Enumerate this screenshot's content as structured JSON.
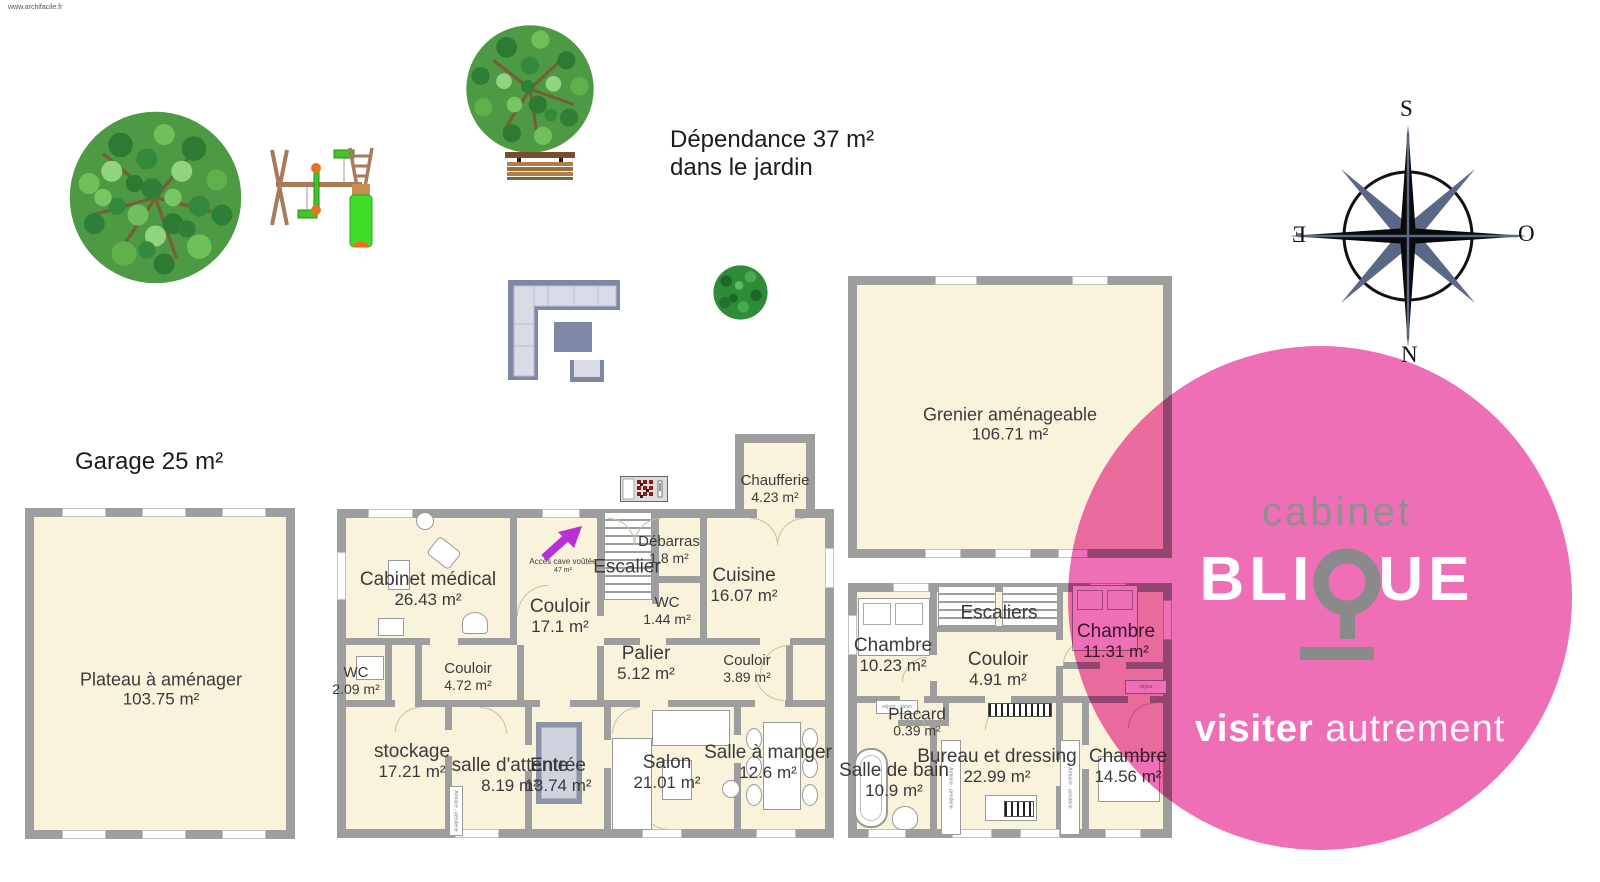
{
  "watermark": "www.archifacile.fr",
  "garden": {
    "dependance_line1": "Dépendance 37 m²",
    "dependance_line2": "dans le jardin",
    "garage_label": "Garage 25 m²"
  },
  "acces_cave": {
    "line1": "Accès cave voûtée",
    "line2": "47 m²"
  },
  "compass": {
    "top": "S",
    "bottom": "N",
    "left": "E",
    "right": "O"
  },
  "logo": {
    "word1": "cabinet",
    "brand_left": "BLI",
    "brand_right": "UE",
    "tagline_bold": "visiter",
    "tagline_light": "autrement",
    "pink": "#ee6fb5",
    "gray": "#8a8a8a"
  },
  "furniture": {
    "wardrobe_label": "Armoire - penderie"
  },
  "colors": {
    "room_fill": "#faf3dc",
    "wall": "#9e9e9e",
    "label_text": "#3a3a3a",
    "arrow_purple": "#bb2fd6",
    "tree_green": "#4e9a44",
    "compass_slate": "#5b6786"
  },
  "rooms": [
    {
      "name": "Plateau à aménager",
      "area": "103.75 m²"
    },
    {
      "name": "Cabinet médical",
      "area": "26.43 m²"
    },
    {
      "name": "Couloir",
      "area": "17.1 m²"
    },
    {
      "name": "Escalier",
      "area": ""
    },
    {
      "name": "Débarras",
      "area": "1.8 m²"
    },
    {
      "name": "Chaufferie",
      "area": "4.23 m²"
    },
    {
      "name": "Cuisine",
      "area": "16.07 m²"
    },
    {
      "name": "WC",
      "area": "1.44 m²"
    },
    {
      "name": "Palier",
      "area": "5.12 m²"
    },
    {
      "name": "Couloir",
      "area": "3.89 m²"
    },
    {
      "name": "WC",
      "area": "2.09 m²"
    },
    {
      "name": "Couloir",
      "area": "4.72 m²"
    },
    {
      "name": "stockage",
      "area": "17.21 m²"
    },
    {
      "name": "salle d'attente",
      "area": "8.19 m²"
    },
    {
      "name": "Entrée",
      "area": "13.74 m²"
    },
    {
      "name": "Salon",
      "area": "21.01 m²"
    },
    {
      "name": "Salle à manger",
      "area": "12.6 m²"
    },
    {
      "name": "Grenier aménageable",
      "area": "106.71 m²"
    },
    {
      "name": "Chambre",
      "area": "10.23 m²"
    },
    {
      "name": "Escaliers",
      "area": ""
    },
    {
      "name": "Couloir",
      "area": "4.91 m²"
    },
    {
      "name": "Chambre",
      "area": "11.31 m²"
    },
    {
      "name": "Placard",
      "area": "0.39 m²"
    },
    {
      "name": "Salle de bain",
      "area": "10.9 m²"
    },
    {
      "name": "Bureau et dressing",
      "area": "22.99 m²"
    },
    {
      "name": "Chambre",
      "area": "14.56 m²"
    }
  ]
}
